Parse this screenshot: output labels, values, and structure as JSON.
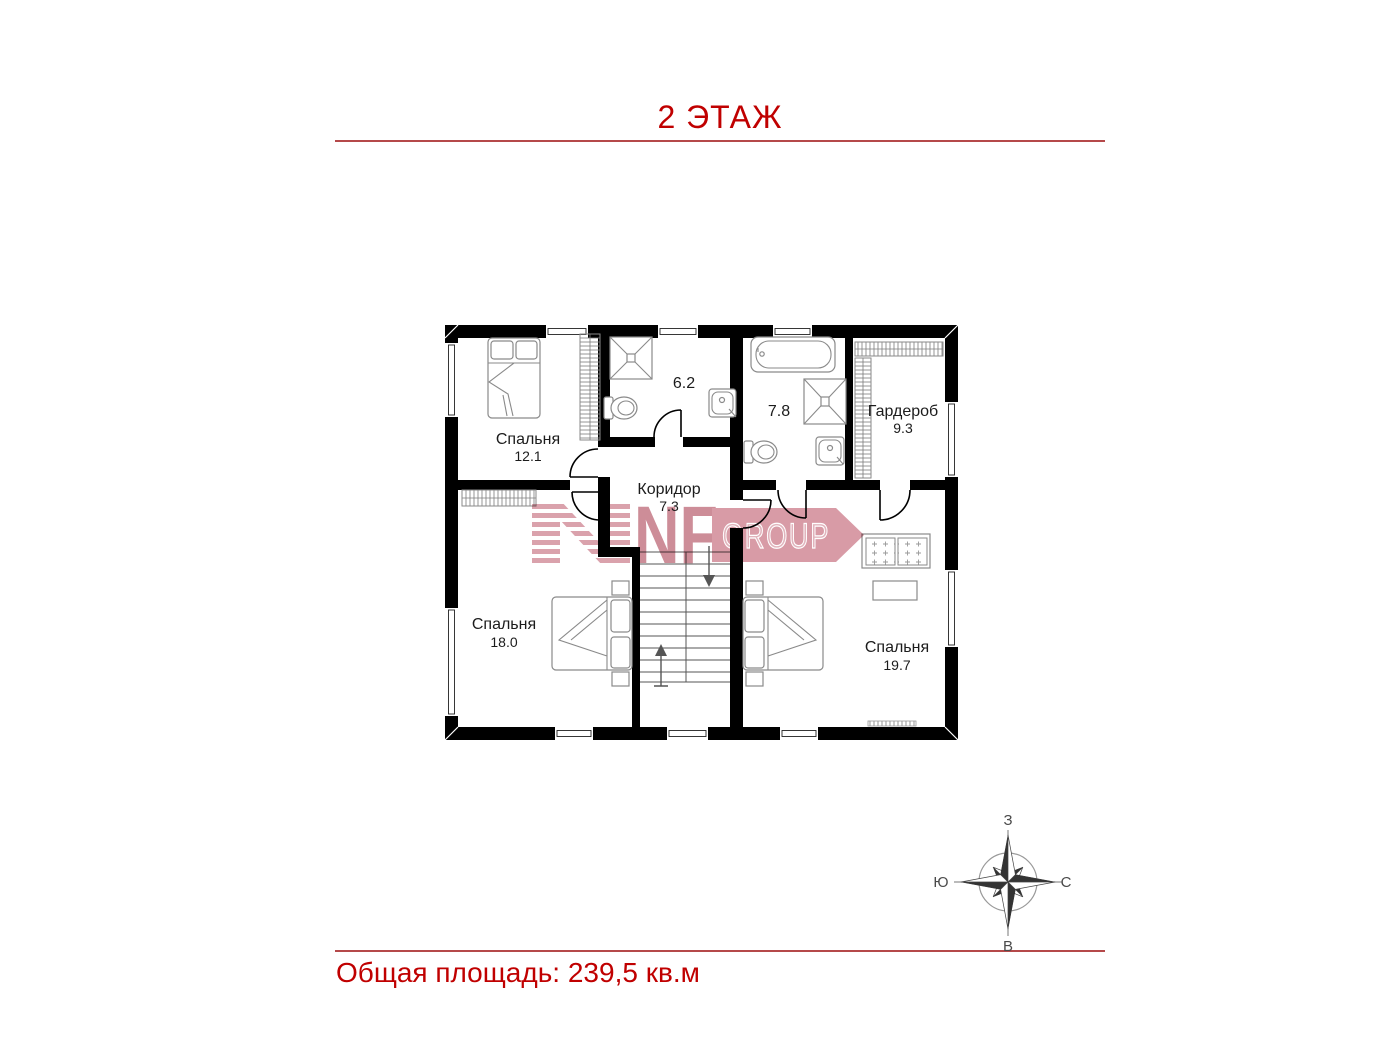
{
  "page": {
    "title": "2 ЭТАЖ",
    "total_area": "Общая площадь: 239,5 кв.м"
  },
  "floor_plan": {
    "rooms": [
      {
        "id": "bedroom-1",
        "name": "Спальня",
        "area": "12.1"
      },
      {
        "id": "bathroom-1",
        "name": "",
        "area": "6.2"
      },
      {
        "id": "bathroom-2",
        "name": "",
        "area": "7.8"
      },
      {
        "id": "wardrobe",
        "name": "Гардероб",
        "area": "9.3"
      },
      {
        "id": "corridor",
        "name": "Коридор",
        "area": "7.3"
      },
      {
        "id": "bedroom-2",
        "name": "Спальня",
        "area": "18.0"
      },
      {
        "id": "bedroom-3",
        "name": "Спальня",
        "area": "19.7"
      }
    ]
  },
  "watermark": {
    "brand": "NF",
    "suffix": "GROUP"
  },
  "compass": {
    "top": "З",
    "right": "С",
    "bottom": "В",
    "left": "Ю"
  },
  "colors": {
    "accent_red": "#c00000",
    "rule_red": "#b5494a",
    "wall_black": "#000000",
    "furniture_gray": "#8a8a8a",
    "watermark_pink": "#d5939f"
  }
}
